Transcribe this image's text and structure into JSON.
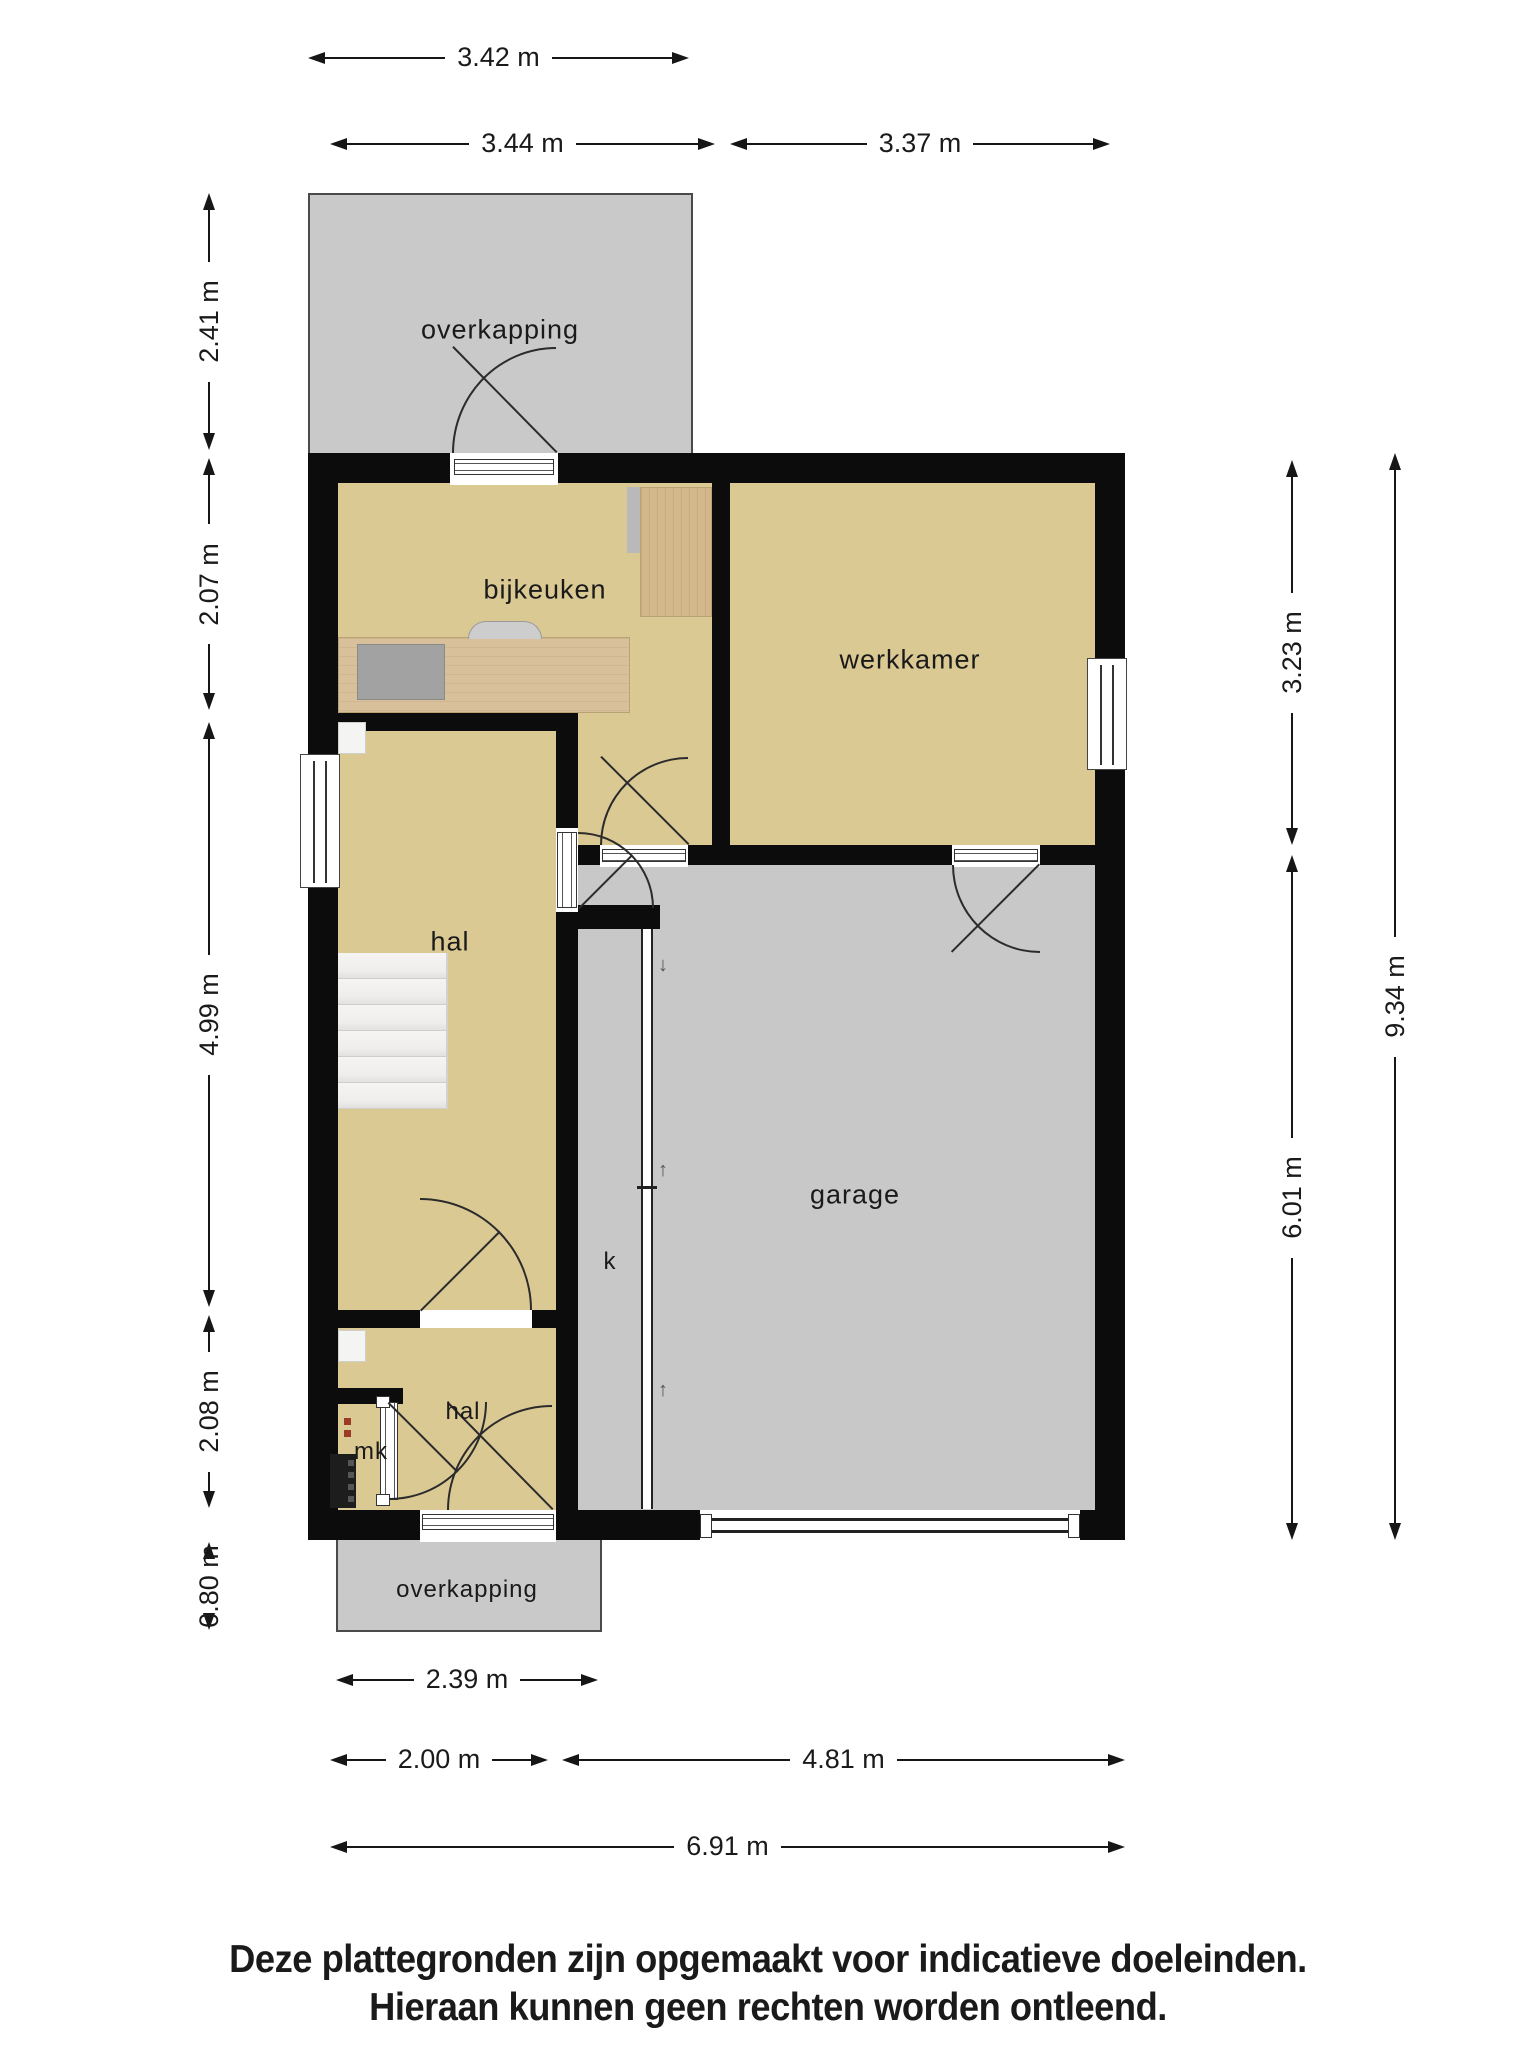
{
  "rooms": {
    "overkapping_top": "overkapping",
    "bijkeuken": "bijkeuken",
    "werkkamer": "werkkamer",
    "hal_upper": "hal",
    "garage": "garage",
    "closet_k": "k",
    "hal_lower": "hal",
    "meter_closet": "mk",
    "overkapping_bottom": "overkapping"
  },
  "dimensions": {
    "top": [
      {
        "label": "3.42 m"
      },
      {
        "label": "3.44 m"
      },
      {
        "label": "3.37 m"
      }
    ],
    "left": [
      {
        "label": "2.41 m"
      },
      {
        "label": "2.07 m"
      },
      {
        "label": "4.99 m"
      },
      {
        "label": "2.08 m"
      },
      {
        "label": "0.80 m"
      }
    ],
    "right": [
      {
        "label": "3.23 m"
      },
      {
        "label": "6.01 m"
      },
      {
        "label": "9.34 m"
      }
    ],
    "bottom": [
      {
        "label": "2.39 m"
      },
      {
        "label": "2.00 m"
      },
      {
        "label": "4.81 m"
      },
      {
        "label": "6.91 m"
      }
    ]
  },
  "icons": {
    "rail_arrows": [
      "↓",
      "↑",
      "↑"
    ]
  },
  "footer": {
    "line1": "Deze plattegronden zijn opgemaakt voor indicatieve doeleinden.",
    "line2": "Hieraan kunnen geen rechten worden ontleend."
  },
  "colors": {
    "floor": "#dbc994",
    "hard": "#c8c8c8",
    "wall": "#0c0c0c",
    "wood": "#d8c09b",
    "wood2": "#d2b88b",
    "text": "#1a1a1a",
    "stair": "#f1f0ee",
    "sink": "#a2a2a2"
  }
}
